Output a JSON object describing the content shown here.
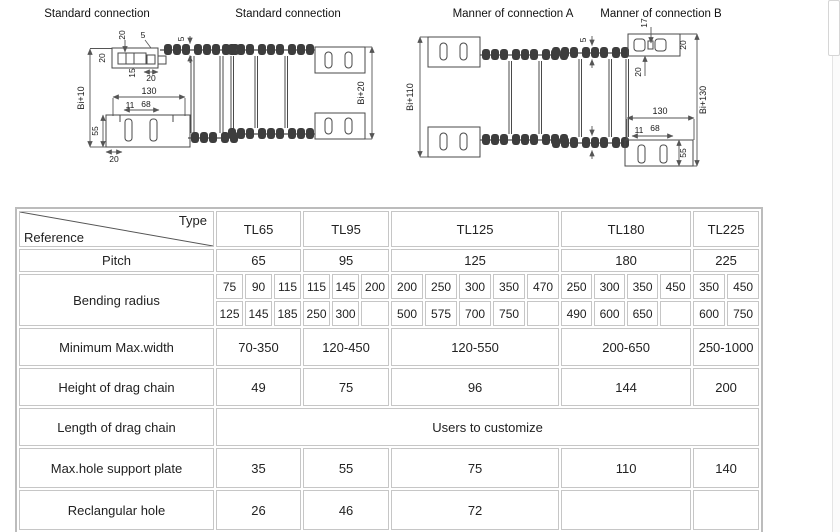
{
  "colors": {
    "table_border": "#c6c6c6",
    "drawing_line": "#4a4a4a",
    "text": "#1a1a1a"
  },
  "diagrams": {
    "panel1": {
      "title": "Standard connection",
      "dim_bi10": "Bi+10",
      "dim_20_left": "20",
      "dim_20_top": "20",
      "dim_5_top": "5",
      "dim_15": "15",
      "dim_20_right": "20",
      "dim_5_chain": "5",
      "dim_130": "130",
      "dim_11": "11",
      "dim_68": "68",
      "dim_55": "55",
      "dim_20_bottom": "20"
    },
    "panel2": {
      "title": "Standard connection",
      "dim_bi20": "Bi+20"
    },
    "panel3": {
      "title": "Manner of connection A",
      "dim_bi110": "Bi+110"
    },
    "panel4": {
      "title": "Manner of connection B",
      "dim_17": "17",
      "dim_20_top": "20",
      "dim_20_below": "20",
      "dim_5": "5",
      "dim_bi130": "Bi+130",
      "dim_130": "130",
      "dim_11": "11",
      "dim_68": "68",
      "dim_55": "55"
    }
  },
  "table": {
    "corner": {
      "type_label": "Type",
      "reference_label": "Reference"
    },
    "columns": [
      "TL65",
      "TL95",
      "TL125",
      "TL180",
      "TL225"
    ],
    "rows": {
      "pitch": {
        "label": "Pitch",
        "values": [
          "65",
          "95",
          "125",
          "180",
          "225"
        ]
      },
      "bending_radius": {
        "label": "Bending radius",
        "row1": [
          "75",
          "90",
          "115",
          "115",
          "145",
          "200",
          "200",
          "250",
          "300",
          "350",
          "470",
          "250",
          "300",
          "350",
          "450",
          "350",
          "450"
        ],
        "row2": [
          "125",
          "145",
          "185",
          "250",
          "300",
          "",
          "500",
          "575",
          "700",
          "750",
          "",
          "490",
          "600",
          "650",
          "",
          "600",
          "750"
        ]
      },
      "min_max_width": {
        "label": "Minimum Max.width",
        "values": [
          "70-350",
          "120-450",
          "120-550",
          "200-650",
          "250-1000"
        ]
      },
      "height": {
        "label": "Height of drag chain",
        "values": [
          "49",
          "75",
          "96",
          "144",
          "200"
        ]
      },
      "length": {
        "label": "Length of drag chain",
        "value": "Users to customize"
      },
      "max_hole": {
        "label": "Max.hole support plate",
        "values": [
          "35",
          "55",
          "75",
          "110",
          "140"
        ]
      },
      "rect_hole": {
        "label": "Reclangular hole",
        "values": [
          "26",
          "46",
          "72",
          "",
          ""
        ]
      }
    }
  }
}
